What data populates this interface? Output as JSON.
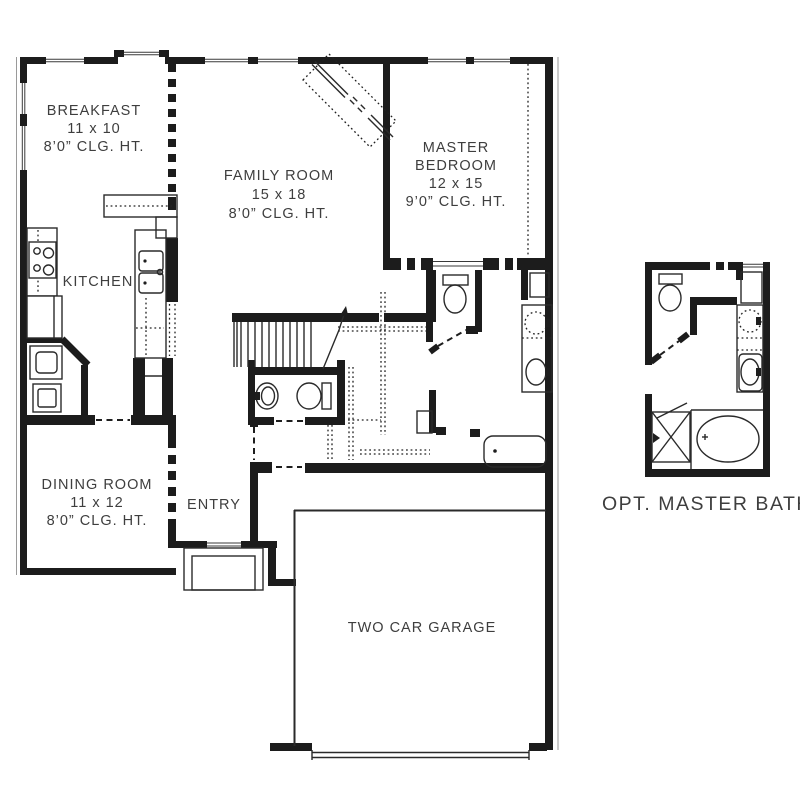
{
  "plan_type": "floor-plan",
  "rooms": {
    "breakfast": {
      "name": "BREAKFAST",
      "dims": "11 x 10",
      "ceiling": "8’0” CLG. HT."
    },
    "kitchen": {
      "name": "KITCHEN"
    },
    "family": {
      "name": "FAMILY ROOM",
      "dims": "15 x 18",
      "ceiling": "8’0” CLG. HT."
    },
    "master": {
      "name_line1": "MASTER",
      "name_line2": "BEDROOM",
      "dims": "12 x 15",
      "ceiling": "9’0” CLG. HT."
    },
    "dining": {
      "name": "DINING ROOM",
      "dims": "11 x 12",
      "ceiling": "8’0” CLG. HT."
    },
    "entry": {
      "name": "ENTRY"
    },
    "garage": {
      "name": "TWO CAR GARAGE"
    },
    "opt_master_bath": {
      "name": "OPT. MASTER BATH"
    }
  },
  "colors": {
    "wall": "#1c1c1c",
    "text": "#3e3e3e",
    "background": "#ffffff"
  }
}
